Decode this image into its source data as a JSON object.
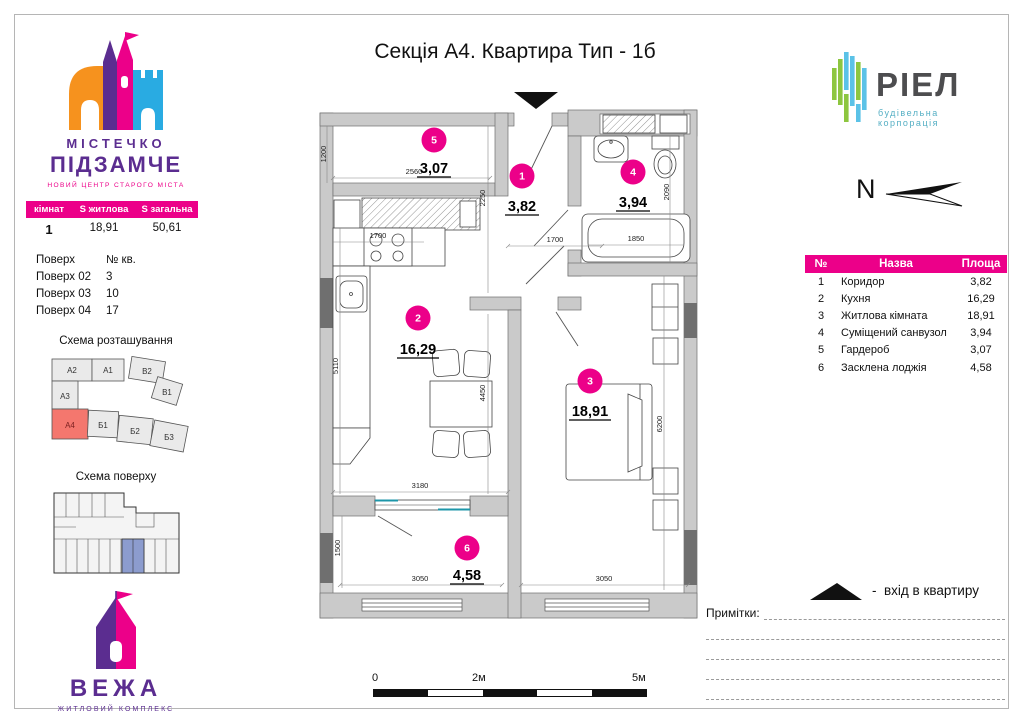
{
  "header": {
    "title": "Секція А4. Квартира Тип - 1б"
  },
  "sidebar": {
    "logo": {
      "line1": "МІСТЕЧКО",
      "line2": "ПІДЗАМЧЕ",
      "tagline": "НОВИЙ ЦЕНТР СТАРОГО МІСТА"
    },
    "summary": {
      "headers": [
        "кімнат",
        "S житлова",
        "S загальна"
      ],
      "values": [
        "1",
        "18,91",
        "50,61"
      ]
    },
    "floors": {
      "headers": [
        "Поверх",
        "№ кв."
      ],
      "rows": [
        [
          "Поверх 02",
          "3"
        ],
        [
          "Поверх 03",
          "10"
        ],
        [
          "Поверх 04",
          "17"
        ]
      ]
    },
    "location": {
      "title": "Схема розташування",
      "blocks": [
        "А2",
        "А1",
        "В2",
        "В1",
        "А3",
        "А4",
        "Б1",
        "Б2",
        "Б3"
      ],
      "highlighted": "А4"
    },
    "floor_scheme": {
      "title": "Схема поверху"
    },
    "tower": {
      "name": "ВЕЖА",
      "tagline": "ЖИТЛОВИЙ КОМПЛЕКС"
    }
  },
  "brand": {
    "name": "РІЕЛ",
    "tagline": "будівельна корпорація"
  },
  "compass": {
    "label": "N"
  },
  "rooms": {
    "headers": [
      "№",
      "Назва",
      "Площа"
    ],
    "rows": [
      [
        "1",
        "Коридор",
        "3,82"
      ],
      [
        "2",
        "Кухня",
        "16,29"
      ],
      [
        "3",
        "Житлова кімната",
        "18,91"
      ],
      [
        "4",
        "Суміщений санвузол",
        "3,94"
      ],
      [
        "5",
        "Гардероб",
        "3,07"
      ],
      [
        "6",
        "Засклена лоджія",
        "4,58"
      ]
    ]
  },
  "plan": {
    "badges": [
      {
        "n": "1",
        "a": "3,82"
      },
      {
        "n": "2",
        "a": "16,29"
      },
      {
        "n": "3",
        "a": "18,91"
      },
      {
        "n": "4",
        "a": "3,94"
      },
      {
        "n": "5",
        "a": "3,07"
      },
      {
        "n": "6",
        "a": "4,58"
      }
    ],
    "dims": {
      "garderob_h": "1200",
      "garderob_w": "2560",
      "hall_h": "2250",
      "kitchen_top": "1700",
      "hall_w": "1700",
      "bath_w": "1850",
      "bath_h": "2090",
      "kitchen_h": "5110",
      "kitchen_inner": "4450",
      "living_h": "6200",
      "kitchen_w": "3180",
      "loggia_h": "1500",
      "loggia_w": "3050",
      "living_w": "3050"
    }
  },
  "legend": {
    "entrance": "-  вхід в квартиру",
    "notes": "Примітки:"
  },
  "scale": {
    "labels": [
      "0",
      "2м",
      "5м"
    ]
  },
  "colors": {
    "accent": "#EC0089",
    "purple": "#5B2D90",
    "orange": "#F6921E",
    "blue": "#29ABE2",
    "green": "#8DC63F",
    "brand_text": "#4D4D4F",
    "wall": "#CACACA",
    "wall_dark": "#6F6F6F",
    "unit_highlight": "#8C9CCE",
    "location_highlight": "#F4776E"
  }
}
